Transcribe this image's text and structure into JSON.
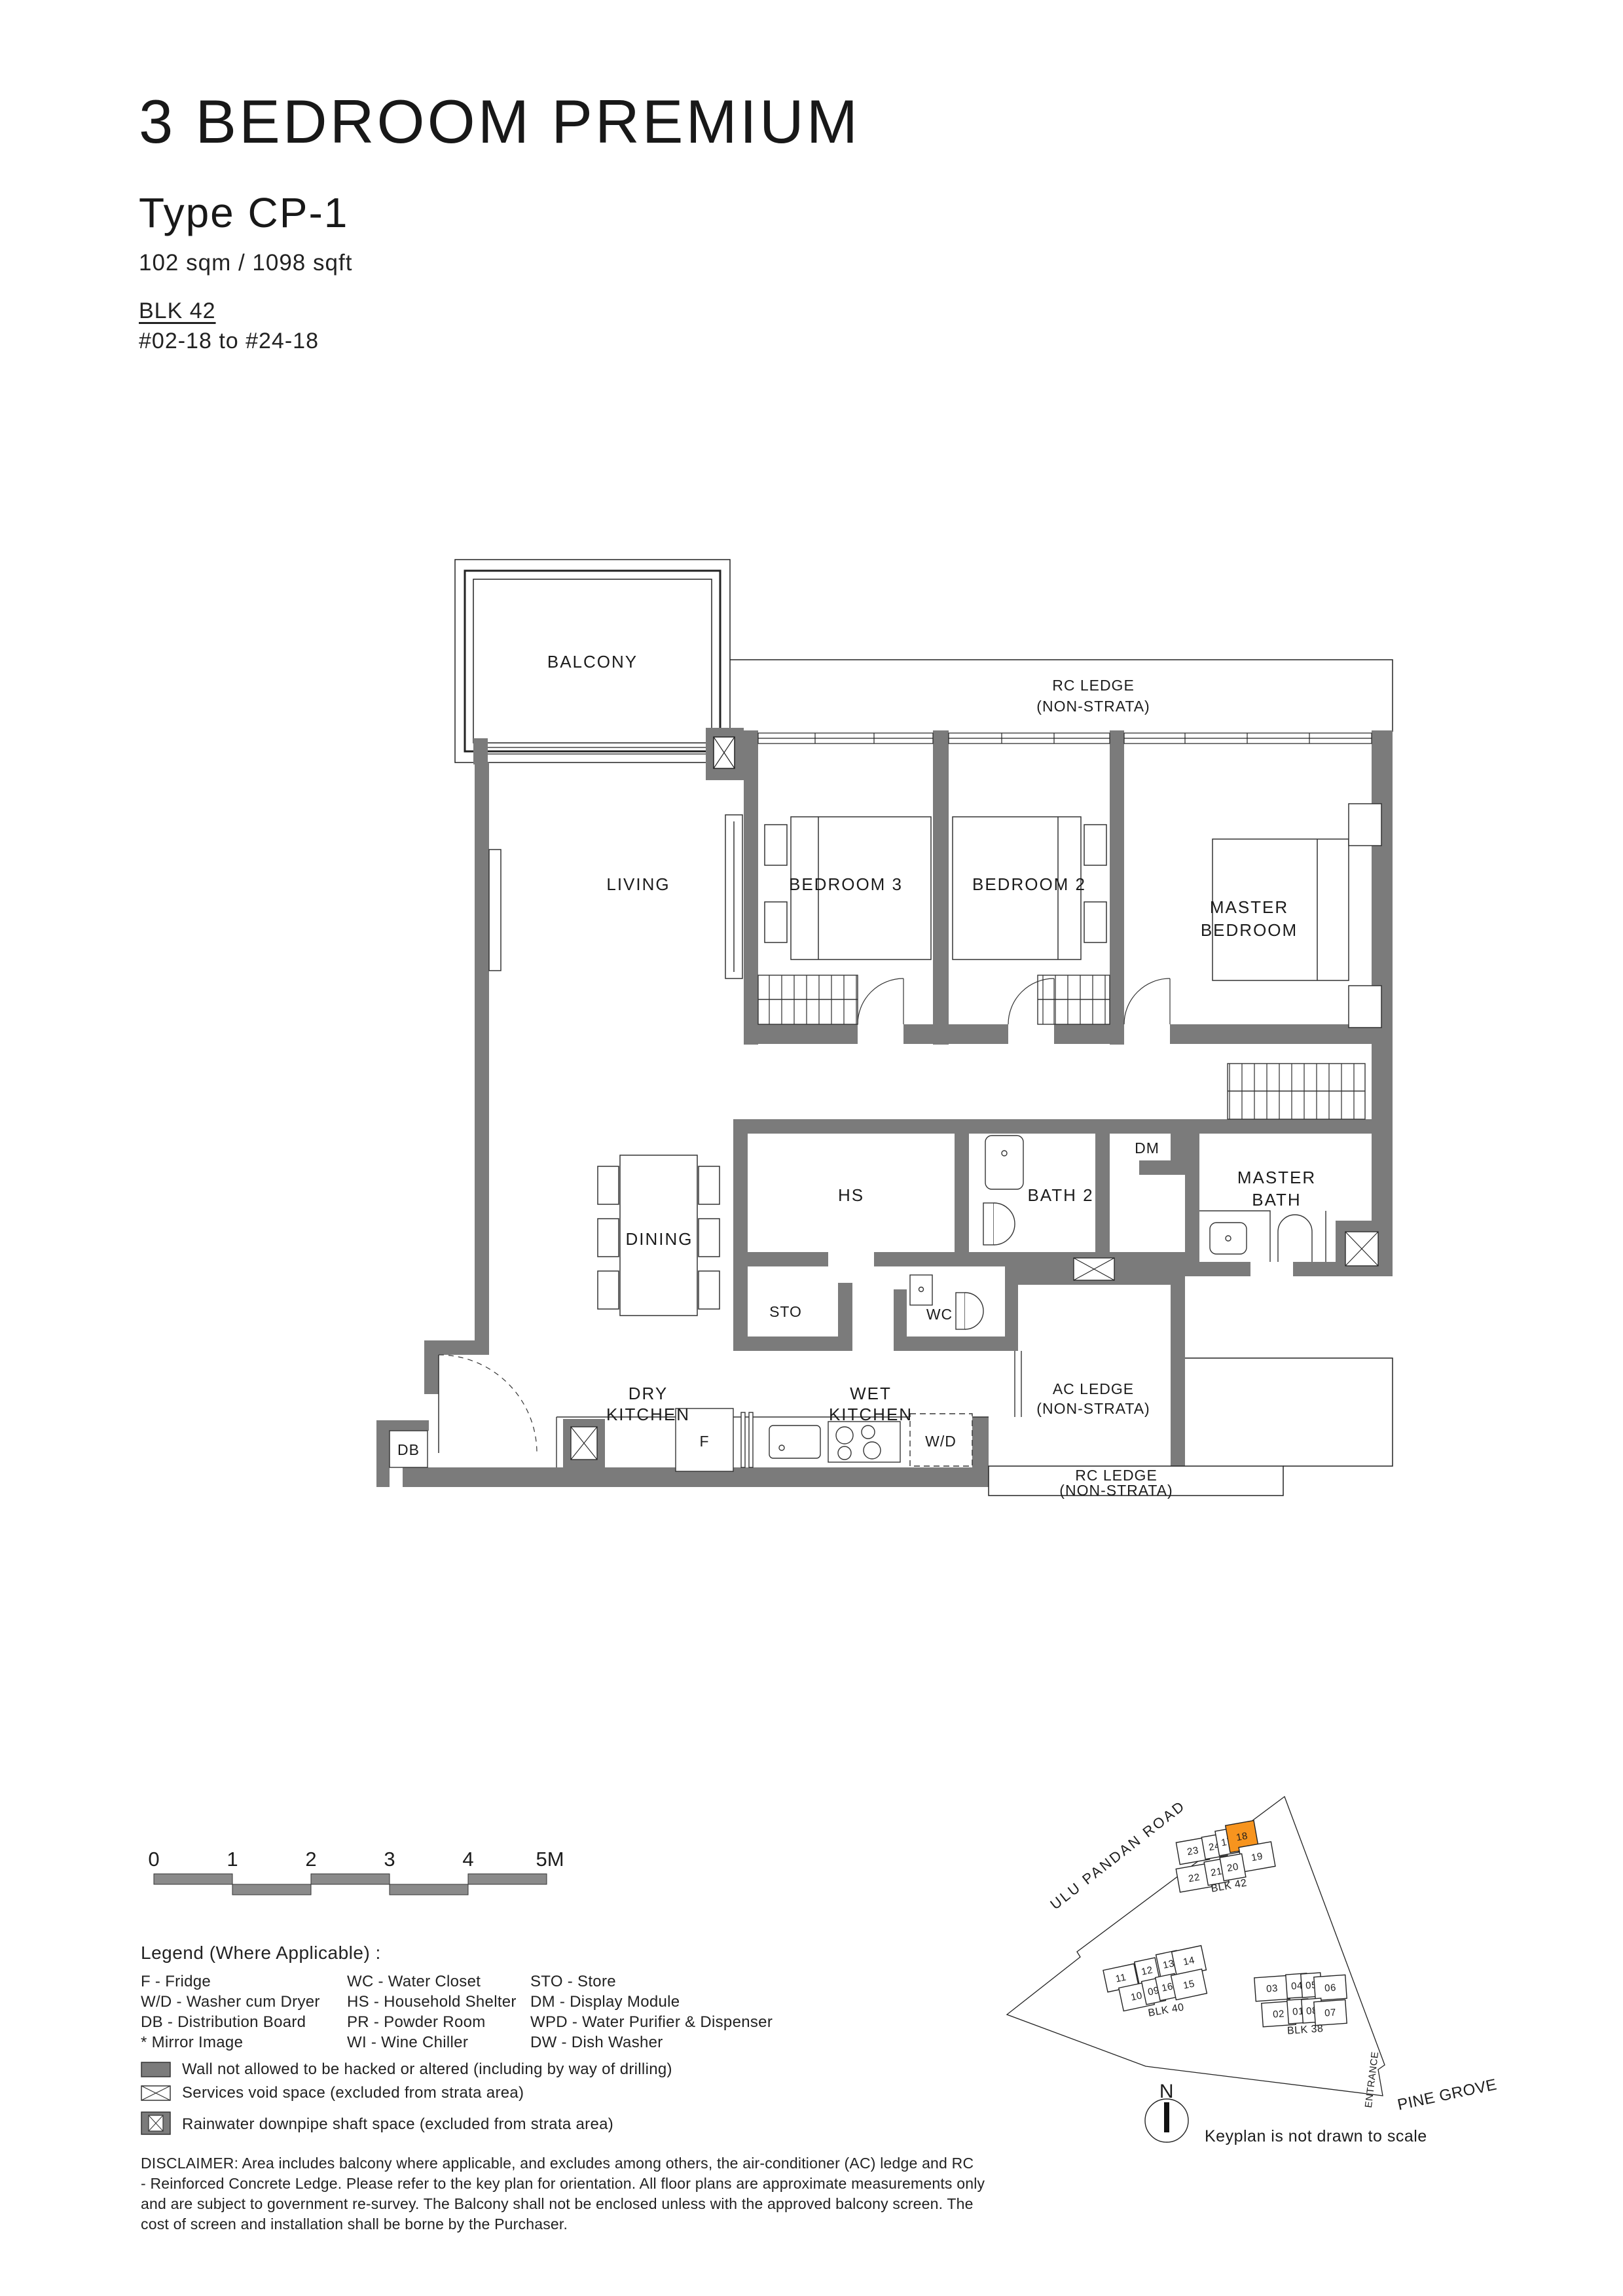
{
  "header": {
    "title": "3 BEDROOM PREMIUM",
    "type": "Type CP-1",
    "area": "102 sqm / 1098 sqft",
    "block": "BLK 42",
    "units": "#02-18 to #24-18"
  },
  "plan": {
    "balcony": "BALCONY",
    "living": "LIVING",
    "bedroom3": "BEDROOM 3",
    "bedroom2": "BEDROOM 2",
    "master_bedroom_1": "MASTER",
    "master_bedroom_2": "BEDROOM",
    "dining": "DINING",
    "hs": "HS",
    "sto": "STO",
    "wc": "WC",
    "bath2": "BATH 2",
    "dm": "DM",
    "master_bath_1": "MASTER",
    "master_bath_2": "BATH",
    "dry_kitchen_1": "DRY",
    "dry_kitchen_2": "KITCHEN",
    "wet_kitchen_1": "WET",
    "wet_kitchen_2": "KITCHEN",
    "ac_ledge_1": "AC LEDGE",
    "ac_ledge_2": "(NON-STRATA)",
    "rc_ledge_top_1": "RC LEDGE",
    "rc_ledge_top_2": "(NON-STRATA)",
    "rc_ledge_bottom_1": "RC LEDGE",
    "rc_ledge_bottom_2": "(NON-STRATA)",
    "db": "DB",
    "fridge": "F",
    "wd": "W/D"
  },
  "scalebar": {
    "ticks": [
      "0",
      "1",
      "2",
      "3",
      "4",
      "5M"
    ]
  },
  "legend": {
    "title": "Legend (Where Applicable) :",
    "col1": [
      "F - Fridge",
      "W/D - Washer cum Dryer",
      "DB - Distribution Board",
      "* Mirror Image"
    ],
    "col2": [
      "WC - Water Closet",
      "HS - Household Shelter",
      "PR - Powder Room",
      "WI - Wine Chiller"
    ],
    "col3": [
      "STO - Store",
      "DM - Display Module",
      "WPD - Water Purifier & Dispenser",
      "DW - Dish Washer"
    ],
    "symbols": [
      "Wall not allowed to be hacked or altered (including by way of drilling)",
      "Services void space (excluded from strata area)",
      "Rainwater downpipe shaft space (excluded from strata area)"
    ]
  },
  "disclaimer": {
    "l1": "DISCLAIMER: Area includes balcony where applicable, and excludes among others, the air-conditioner (AC) ledge and RC",
    "l2": "- Reinforced Concrete Ledge. Please refer to the key plan for orientation. All floor plans are approximate measurements only",
    "l3": "and are subject to government re-survey. The Balcony shall not be enclosed unless with the approved balcony screen. The",
    "l4": "cost of screen and installation shall be borne by the Purchaser."
  },
  "keyplan": {
    "road_top": "ULU  PANDAN  ROAD",
    "road_right": "PINE GROVE",
    "entrance": "ENTRANCE",
    "compass": "N",
    "note": "Keyplan is not drawn to scale",
    "highlight_color": "#F7941E",
    "blk42": {
      "label": "BLK 42",
      "u23": "23",
      "u24": "24",
      "u17": "17",
      "u18": "18",
      "u19": "19",
      "u22": "22",
      "u21": "21",
      "u20": "20"
    },
    "blk40": {
      "label": "BLK 40",
      "u11": "11",
      "u12": "12",
      "u13": "13",
      "u14": "14",
      "u10": "10",
      "u09": "09",
      "u16": "16",
      "u15": "15"
    },
    "blk38": {
      "label": "BLK 38",
      "u03": "03",
      "u04": "04",
      "u05": "05",
      "u06": "06",
      "u02": "02",
      "u01": "01",
      "u08": "08",
      "u07": "07"
    }
  }
}
